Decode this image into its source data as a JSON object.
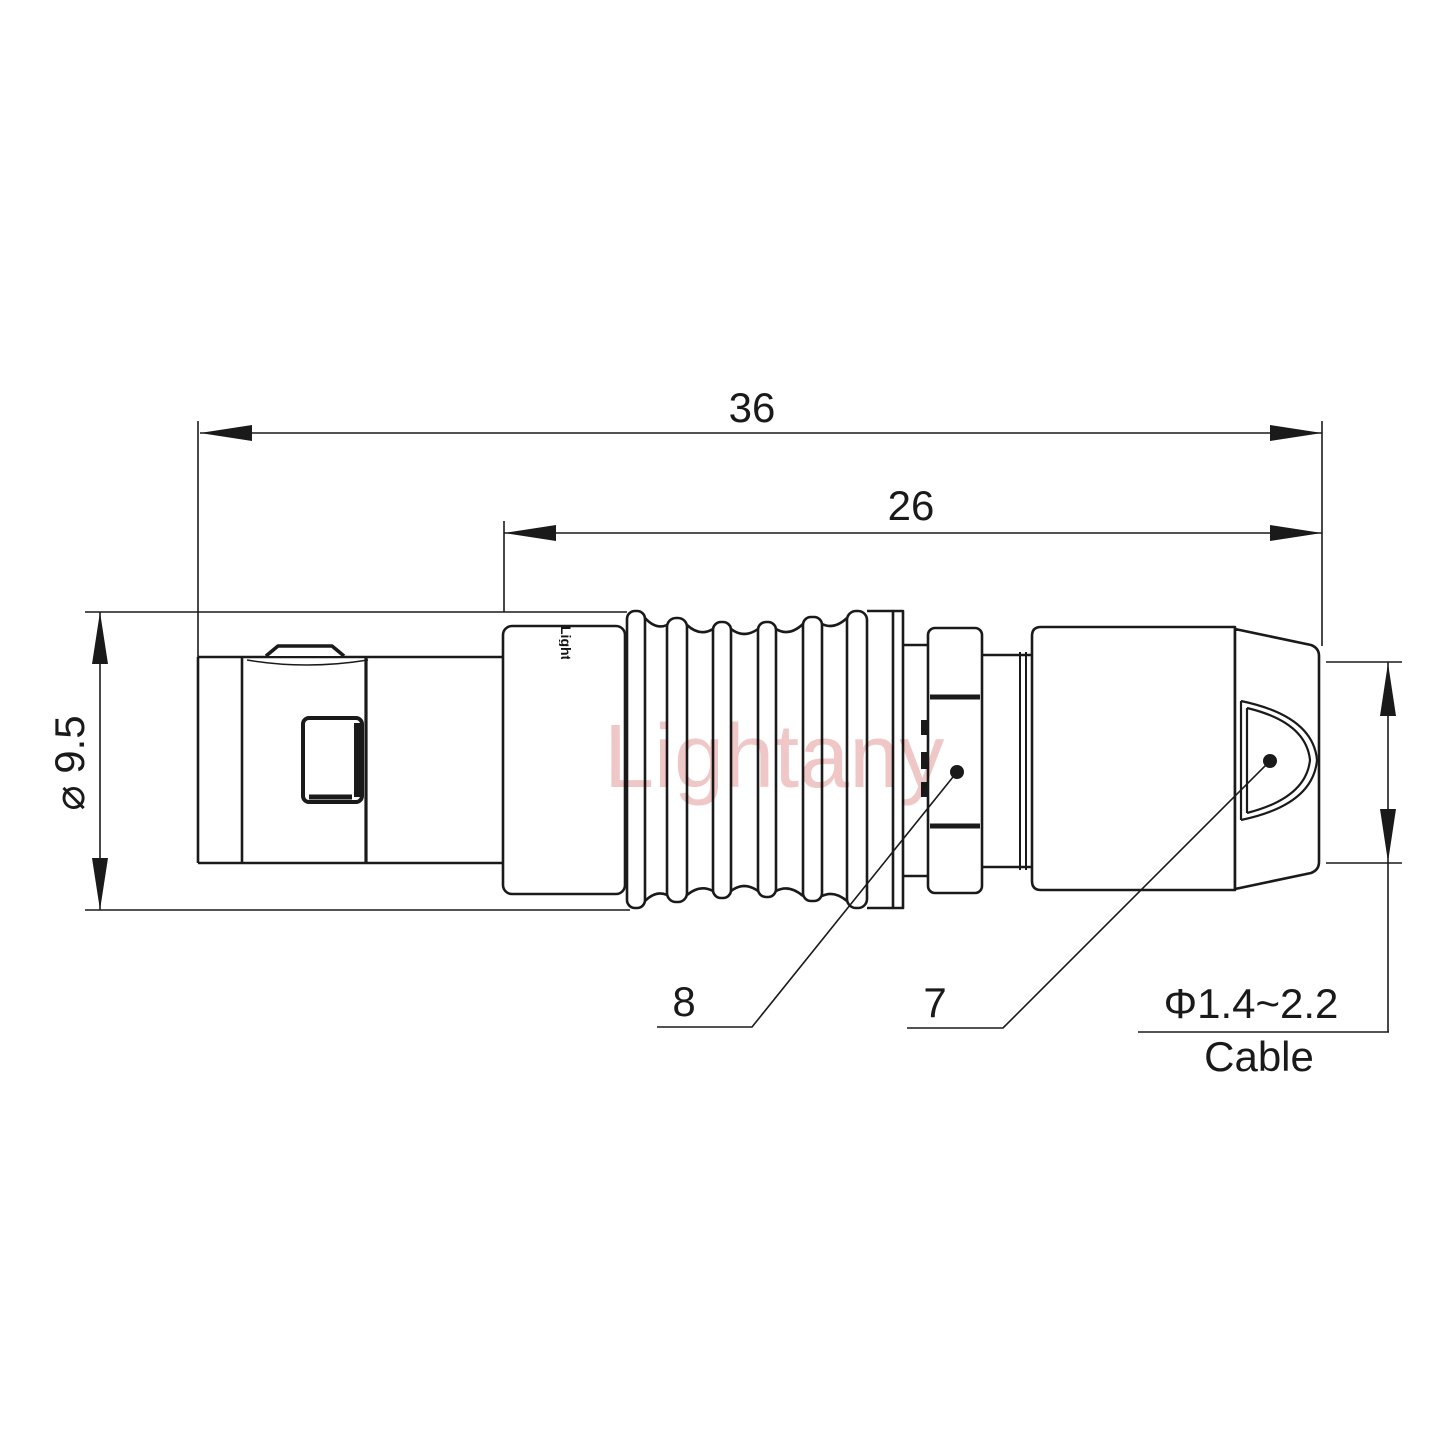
{
  "watermark": {
    "text": "Lightany",
    "color": "#efc7c7"
  },
  "connector": {
    "logo_text": "Lightany"
  },
  "dimensions": {
    "overall_length": "36",
    "rear_section_length": "26",
    "shell_diameter": "⌀ 9.5",
    "cable_range": "Φ1.4~2.2",
    "cable_caption": "Cable"
  },
  "callouts": {
    "collet_nut": "8",
    "rear_nut": "7"
  },
  "colors": {
    "line": "#1a1a1a",
    "background": "#ffffff",
    "watermark": "#efc7c7"
  }
}
